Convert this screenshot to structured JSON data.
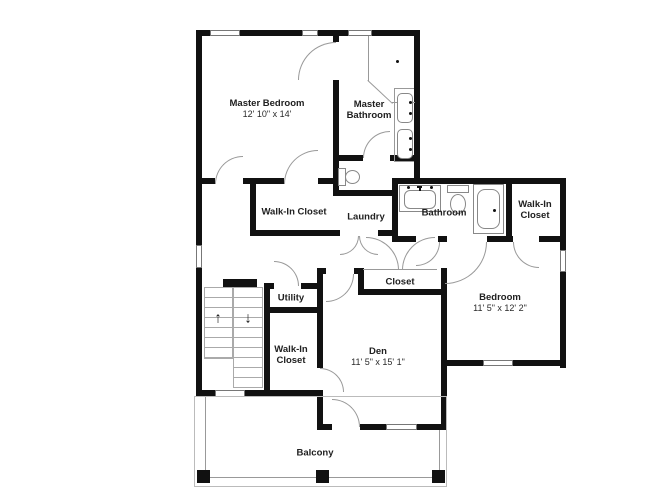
{
  "rooms": {
    "master_bedroom": {
      "label": "Master Bedroom",
      "dims": "12' 10\" x 14'"
    },
    "master_bathroom": {
      "line1": "Master",
      "line2": "Bathroom"
    },
    "walk_in_closet_master": {
      "label": "Walk-In Closet"
    },
    "laundry": {
      "label": "Laundry"
    },
    "bathroom": {
      "label": "Bathroom"
    },
    "walk_in_closet_bedroom": {
      "line1": "Walk-In",
      "line2": "Closet"
    },
    "bedroom": {
      "label": "Bedroom",
      "dims": "11' 5\" x 12' 2\""
    },
    "utility": {
      "label": "Utility"
    },
    "walk_in_closet_den": {
      "line1": "Walk-In",
      "line2": "Closet"
    },
    "closet": {
      "label": "Closet"
    },
    "den": {
      "label": "Den",
      "dims": "11' 5\" x 15' 1\""
    },
    "balcony": {
      "label": "Balcony"
    }
  },
  "stairs": {
    "up_arrow": "↑",
    "down_arrow": "↓"
  },
  "colors": {
    "wall": "#111111",
    "door_arc": "#999999",
    "text": "#202020"
  }
}
